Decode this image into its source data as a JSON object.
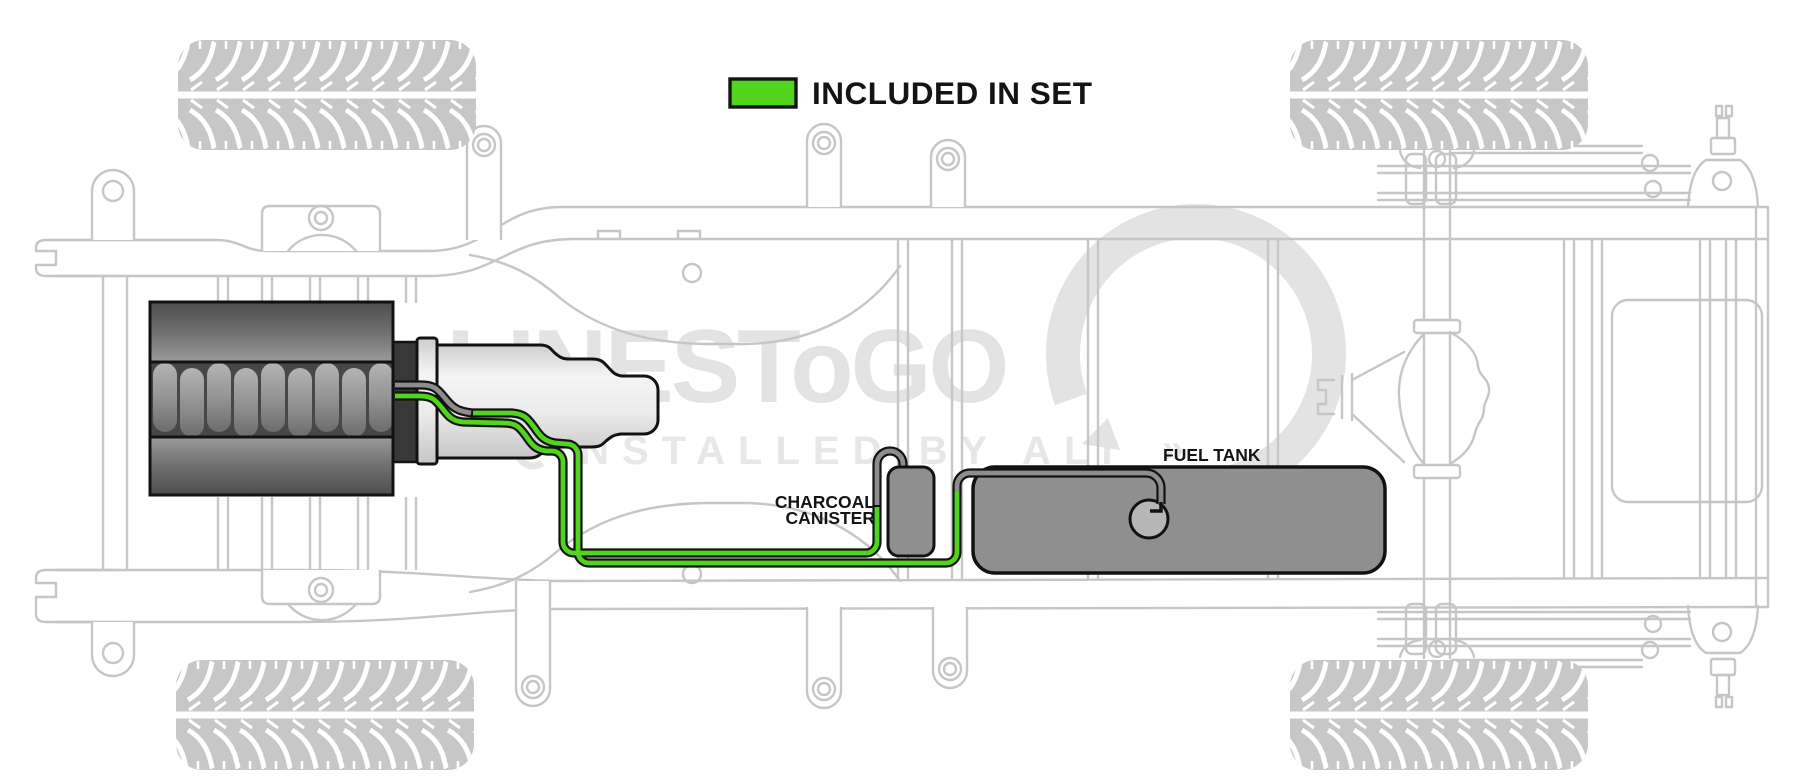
{
  "legend": {
    "label": "INCLUDED IN SET",
    "swatch_color": "#50d41e"
  },
  "component_labels": {
    "charcoal_canister_line1": "CHARCOAL",
    "charcoal_canister_line2": "CANISTER",
    "fuel_tank": "FUEL TANK"
  },
  "watermark": {
    "brand": "LINESToGO",
    "tagline": "INSTALLED BY ALI",
    "mark": "»"
  },
  "colors": {
    "included_line": "#50d41e",
    "excluded_line": "#8d8d8d",
    "outline": "#141414",
    "frame": "#c6c6c6",
    "watermark": "#e3e3e3",
    "component_fill": "#8f8f8f"
  }
}
